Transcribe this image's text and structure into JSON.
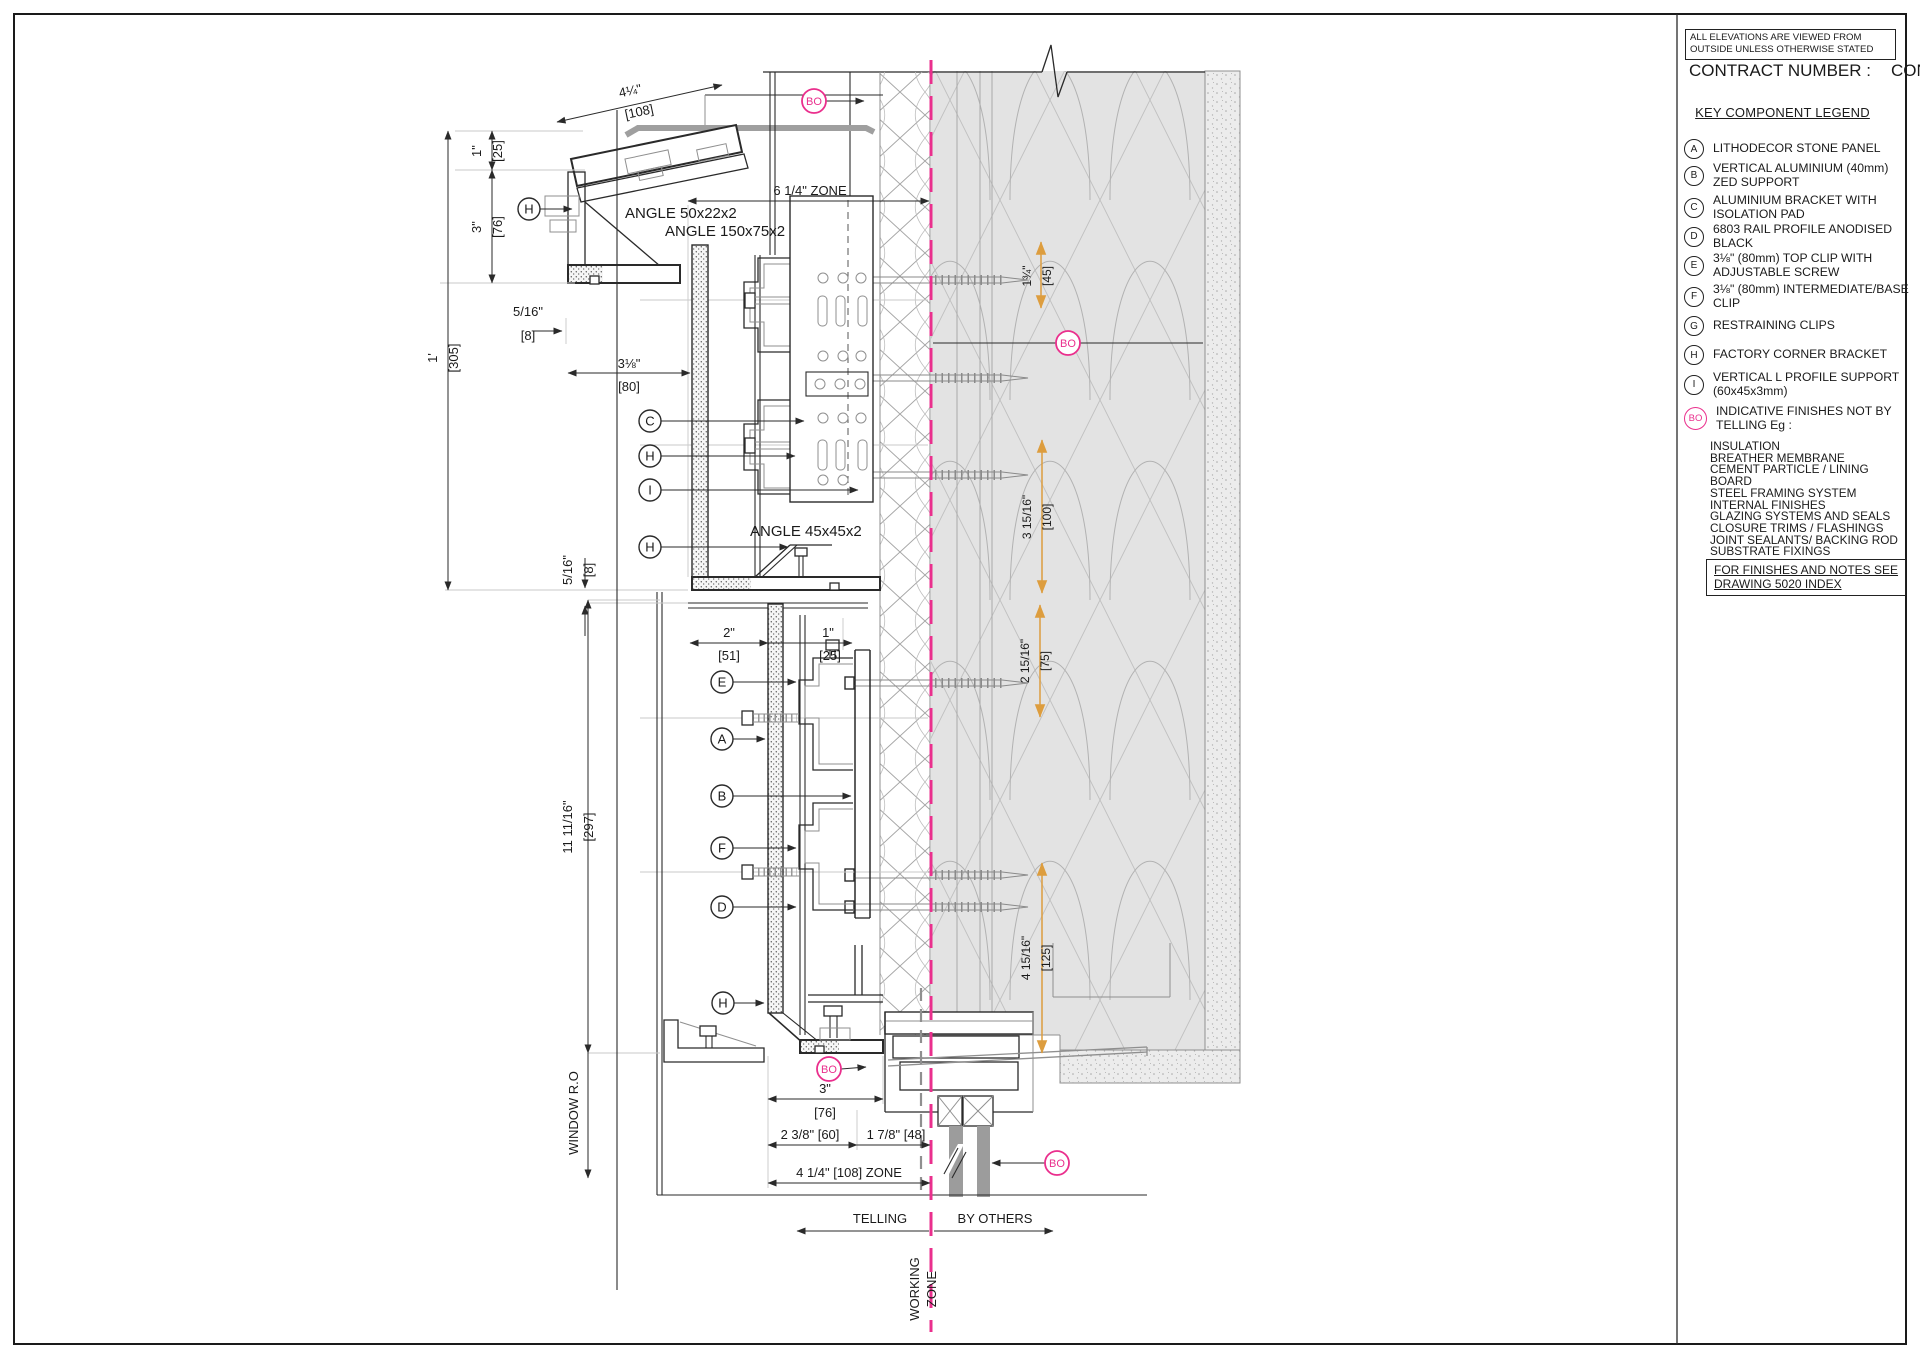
{
  "colors": {
    "accent_pink": "#ea2f8d",
    "accent_orange": "#dd9d3e"
  },
  "legend": {
    "note": "ALL ELEVATIONS ARE VIEWED FROM OUTSIDE\nUNLESS OTHERWISE STATED",
    "contract_label": "CONTRACT NUMBER :",
    "contract_value": "CONNO",
    "title": "KEY COMPONENT LEGEND",
    "items": [
      {
        "key": "A",
        "label": "LITHODECOR STONE PANEL"
      },
      {
        "key": "B",
        "label": "VERTICAL ALUMINIUM (40mm)\nZED SUPPORT"
      },
      {
        "key": "C",
        "label": "ALUMINIUM BRACKET WITH\nISOLATION PAD"
      },
      {
        "key": "D",
        "label": "6803 RAIL PROFILE ANODISED\nBLACK"
      },
      {
        "key": "E",
        "label": "3⅛\" (80mm) TOP CLIP WITH\nADJUSTABLE SCREW"
      },
      {
        "key": "F",
        "label": "3⅛\" (80mm) INTERMEDIATE/BASE\nCLIP"
      },
      {
        "key": "G",
        "label": "RESTRAINING CLIPS"
      },
      {
        "key": "H",
        "label": "FACTORY CORNER BRACKET"
      },
      {
        "key": "I",
        "label": "VERTICAL L PROFILE SUPPORT\n(60x45x3mm)"
      },
      {
        "key": "BO",
        "label": "INDICATIVE FINISHES NOT BY\nTELLING Eg :"
      }
    ],
    "finishes": "INSULATION\nBREATHER MEMBRANE\nCEMENT PARTICLE / LINING\nBOARD\nSTEEL FRAMING SYSTEM\nINTERNAL FINISHES\nGLAZING SYSTEMS AND SEALS\nCLOSURE TRIMS / FLASHINGS\nJOINT SEALANTS/ BACKING ROD\nSUBSTRATE FIXINGS",
    "finishes_note": "FOR FINISHES AND NOTES SEE\nDRAWING 5020 INDEX"
  },
  "drawing": {
    "labels": {
      "angle1": "ANGLE 50x22x2",
      "angle2": "ANGLE 150x75x2",
      "angle3": "ANGLE 45x45x2",
      "zone6": "6 1/4\" ZONE",
      "zone4": "4 1/4\" [108] ZONE",
      "telling": "TELLING",
      "by_others": "BY OTHERS",
      "working1": "WORKING",
      "working2": "ZONE",
      "window_ro": "WINDOW R.O"
    },
    "letters": {
      "a": "A",
      "b": "B",
      "c": "C",
      "d": "D",
      "e": "E",
      "f": "F",
      "h": "H",
      "i": "I",
      "bo": "BO"
    },
    "dims": {
      "d108i": "4¼\"",
      "d108m": "[108]",
      "d25i": "1\"",
      "d25m": "[25]",
      "d76i": "3\"",
      "d76m": "[76]",
      "d305i": "1'",
      "d305m": "[305]",
      "d8i": "5/16\"",
      "d8m": "[8]",
      "d80i": "3⅛\"",
      "d80m": "[80]",
      "d51i": "2\"",
      "d51m": "[51]",
      "d297i": "11 11/16\"",
      "d297m": "[297]",
      "d45i": "1¾\"",
      "d45m": "[45]",
      "d100i": "3 15/16\"",
      "d100m": "[100]",
      "d75i": "2 15/16\"",
      "d75m": "[75]",
      "d125i": "4 15/16\"",
      "d125m": "[125]",
      "d60": "2 3/8\" [60]",
      "d48": "1 7/8\" [48]"
    }
  }
}
